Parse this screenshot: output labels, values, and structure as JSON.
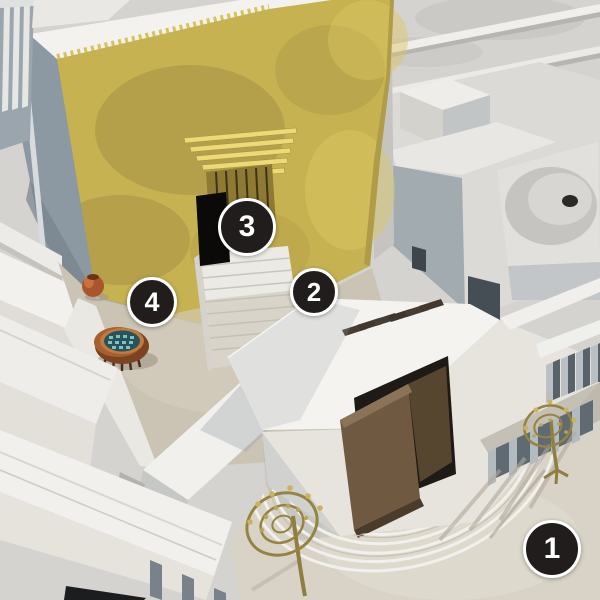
{
  "markers": [
    {
      "label": "1"
    },
    {
      "label": "2"
    },
    {
      "label": "3"
    },
    {
      "label": "4"
    }
  ],
  "palette": {
    "badge_bg": "#211d1c",
    "badge_ring": "#ffffff",
    "badge_text": "#ffffff",
    "gold": "#c7b251",
    "stone": "#e7e4de",
    "stone_bright": "#f4f3ef",
    "shadow_stone": "#a2abb0",
    "courtyard": "#cbc4b5",
    "bronze": "#7c4322",
    "laver_water": "#27535c",
    "wood": "#6f5941",
    "menorah_gold": "#95843f"
  }
}
